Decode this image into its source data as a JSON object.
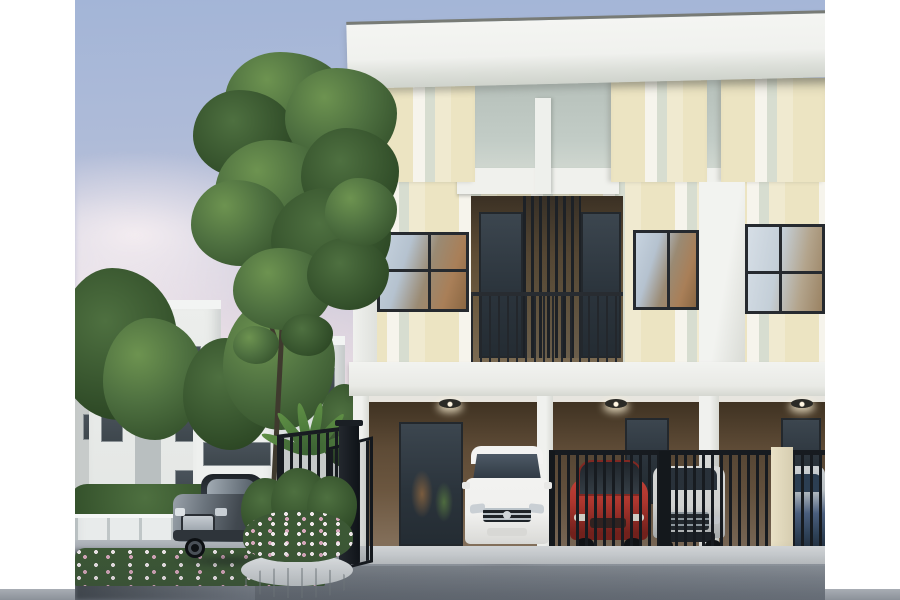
{
  "image": {
    "title": "Modern two-storey townhouse development at dusk",
    "type": "3D architectural rendering",
    "alt": "Row of cream and white striped two-storey townhouses with balconies, carports and a gated driveway. A dark grey sedan drives past a circular stone planter filled with white and pink flowers. A white minivan is parked in an open carport while a red hatchback, a white SUV and a blue car sit behind dark vertical-bar gates. White neighbouring houses, a white perimeter fence with a flowering hedge, leafy green trees and a pink-tinged evening sky fill the background. The photo is centered with white borders on the left and right."
  },
  "layout": {
    "canvas_width": 900,
    "canvas_height": 600,
    "photo_left": 75,
    "photo_width": 750,
    "photo_height": 600,
    "border_color": "#ffffff"
  },
  "colors": {
    "sky_top": "#a3b5d7",
    "sky_pink": "#e9dde2",
    "cloud": "#f3ecf0",
    "roof_white": "#f4f5f2",
    "roof_edge": "#787b76",
    "facade_cream": "#ece4c2",
    "facade_cream_light": "#f0ead0",
    "stripe_white": "#f6f4ec",
    "stripe_green": "#d7ddd0",
    "attic_recess": "#c2ccc6",
    "slab_white": "#f0f1ed",
    "pillar_white": "#eef0ec",
    "window_frame": "#262a2f",
    "glass_sky": "#c7d3df",
    "glass_tan": "#a97f58",
    "balcony_brown": "#5e4c34",
    "louver_dark": "#1d2126",
    "railing_dark": "#23272c",
    "carport_brown": "#6b563f",
    "carport_brown_light": "#85715c",
    "soffit": "#e7e5df",
    "fence_dark": "#171b20",
    "gate_post_cream": "#e9e1c6",
    "curb": "#ccd0d3",
    "road": "#9aa0a8",
    "road_dark": "#4e555c",
    "fence_white": "#e8ebeb",
    "hedge_green": "#3c5835",
    "flower_white": "#efe7ea",
    "flower_pink": "#d8a8bc",
    "tree_green": "#4e7040",
    "tree_green_dark": "#35522c",
    "tree_green_light": "#6d9350",
    "trunk": "#3f3a2e",
    "palm_green": "#5f8f45",
    "house_white": "#eceeec",
    "house_grey": "#c7cbca",
    "panel_grey": "#b9bfc0",
    "window_dark": "#3e474d",
    "sedan_dark": "#41484f",
    "van_white": "#f0f0ee",
    "car_red": "#c0392f",
    "suv_white": "#e9eae8",
    "car_blue": "#51678a",
    "planter_stone": "#c8cdd0"
  },
  "scene": {
    "sky": {
      "description": "dusk sky, blue above fading to pink, soft clouds lower left"
    },
    "background_houses": {
      "count": 4,
      "style": "white and grey modern flat-roof houses"
    },
    "boundary": {
      "fence": "white perimeter wall with posts",
      "hedge": "flowering hedge with white and pink blooms"
    },
    "trees": {
      "large_tree": "tall leafy green tree in front of the building",
      "small_trees": 3,
      "palm": "small palm shrub beside the entrance gate"
    },
    "main_building": {
      "storeys": 2,
      "units_visible": 3,
      "facade": "vertical stripes of cream, white and sage",
      "roof": "white flat roof slab with dark edge",
      "second_floor": {
        "windows": 3,
        "balcony": {
          "louvers": "dark vertical slat screen",
          "railing": "dark metal bar railing"
        }
      },
      "ground_floor": {
        "carports": 3,
        "ceiling_lights": 3,
        "glass_doors": 3,
        "gate": "dark vertical-bar security fence with cream masonry post",
        "open_gate_leaf": "one dark gate leaf swung open at the left carport"
      }
    },
    "vehicles": [
      {
        "name": "grey-sedan",
        "color": "#454c54",
        "location": "driveway, left foreground"
      },
      {
        "name": "white-minivan",
        "color": "#f0f0ee",
        "location": "carport 1, in front of gate"
      },
      {
        "name": "red-hatchback",
        "color": "#c0392f",
        "location": "behind gate, carport 2"
      },
      {
        "name": "white-suv",
        "color": "#e9eae8",
        "location": "behind gate, carport 2-3"
      },
      {
        "name": "blue-car",
        "color": "#51678a",
        "location": "behind gate, right edge"
      }
    ],
    "foreground": {
      "road": "grey asphalt driveway with soft shadows",
      "planter": "round stone planter with shrubs and white-pink flowers",
      "entrance_gate": "dark metal gate panel and corner column beside the planter"
    }
  }
}
